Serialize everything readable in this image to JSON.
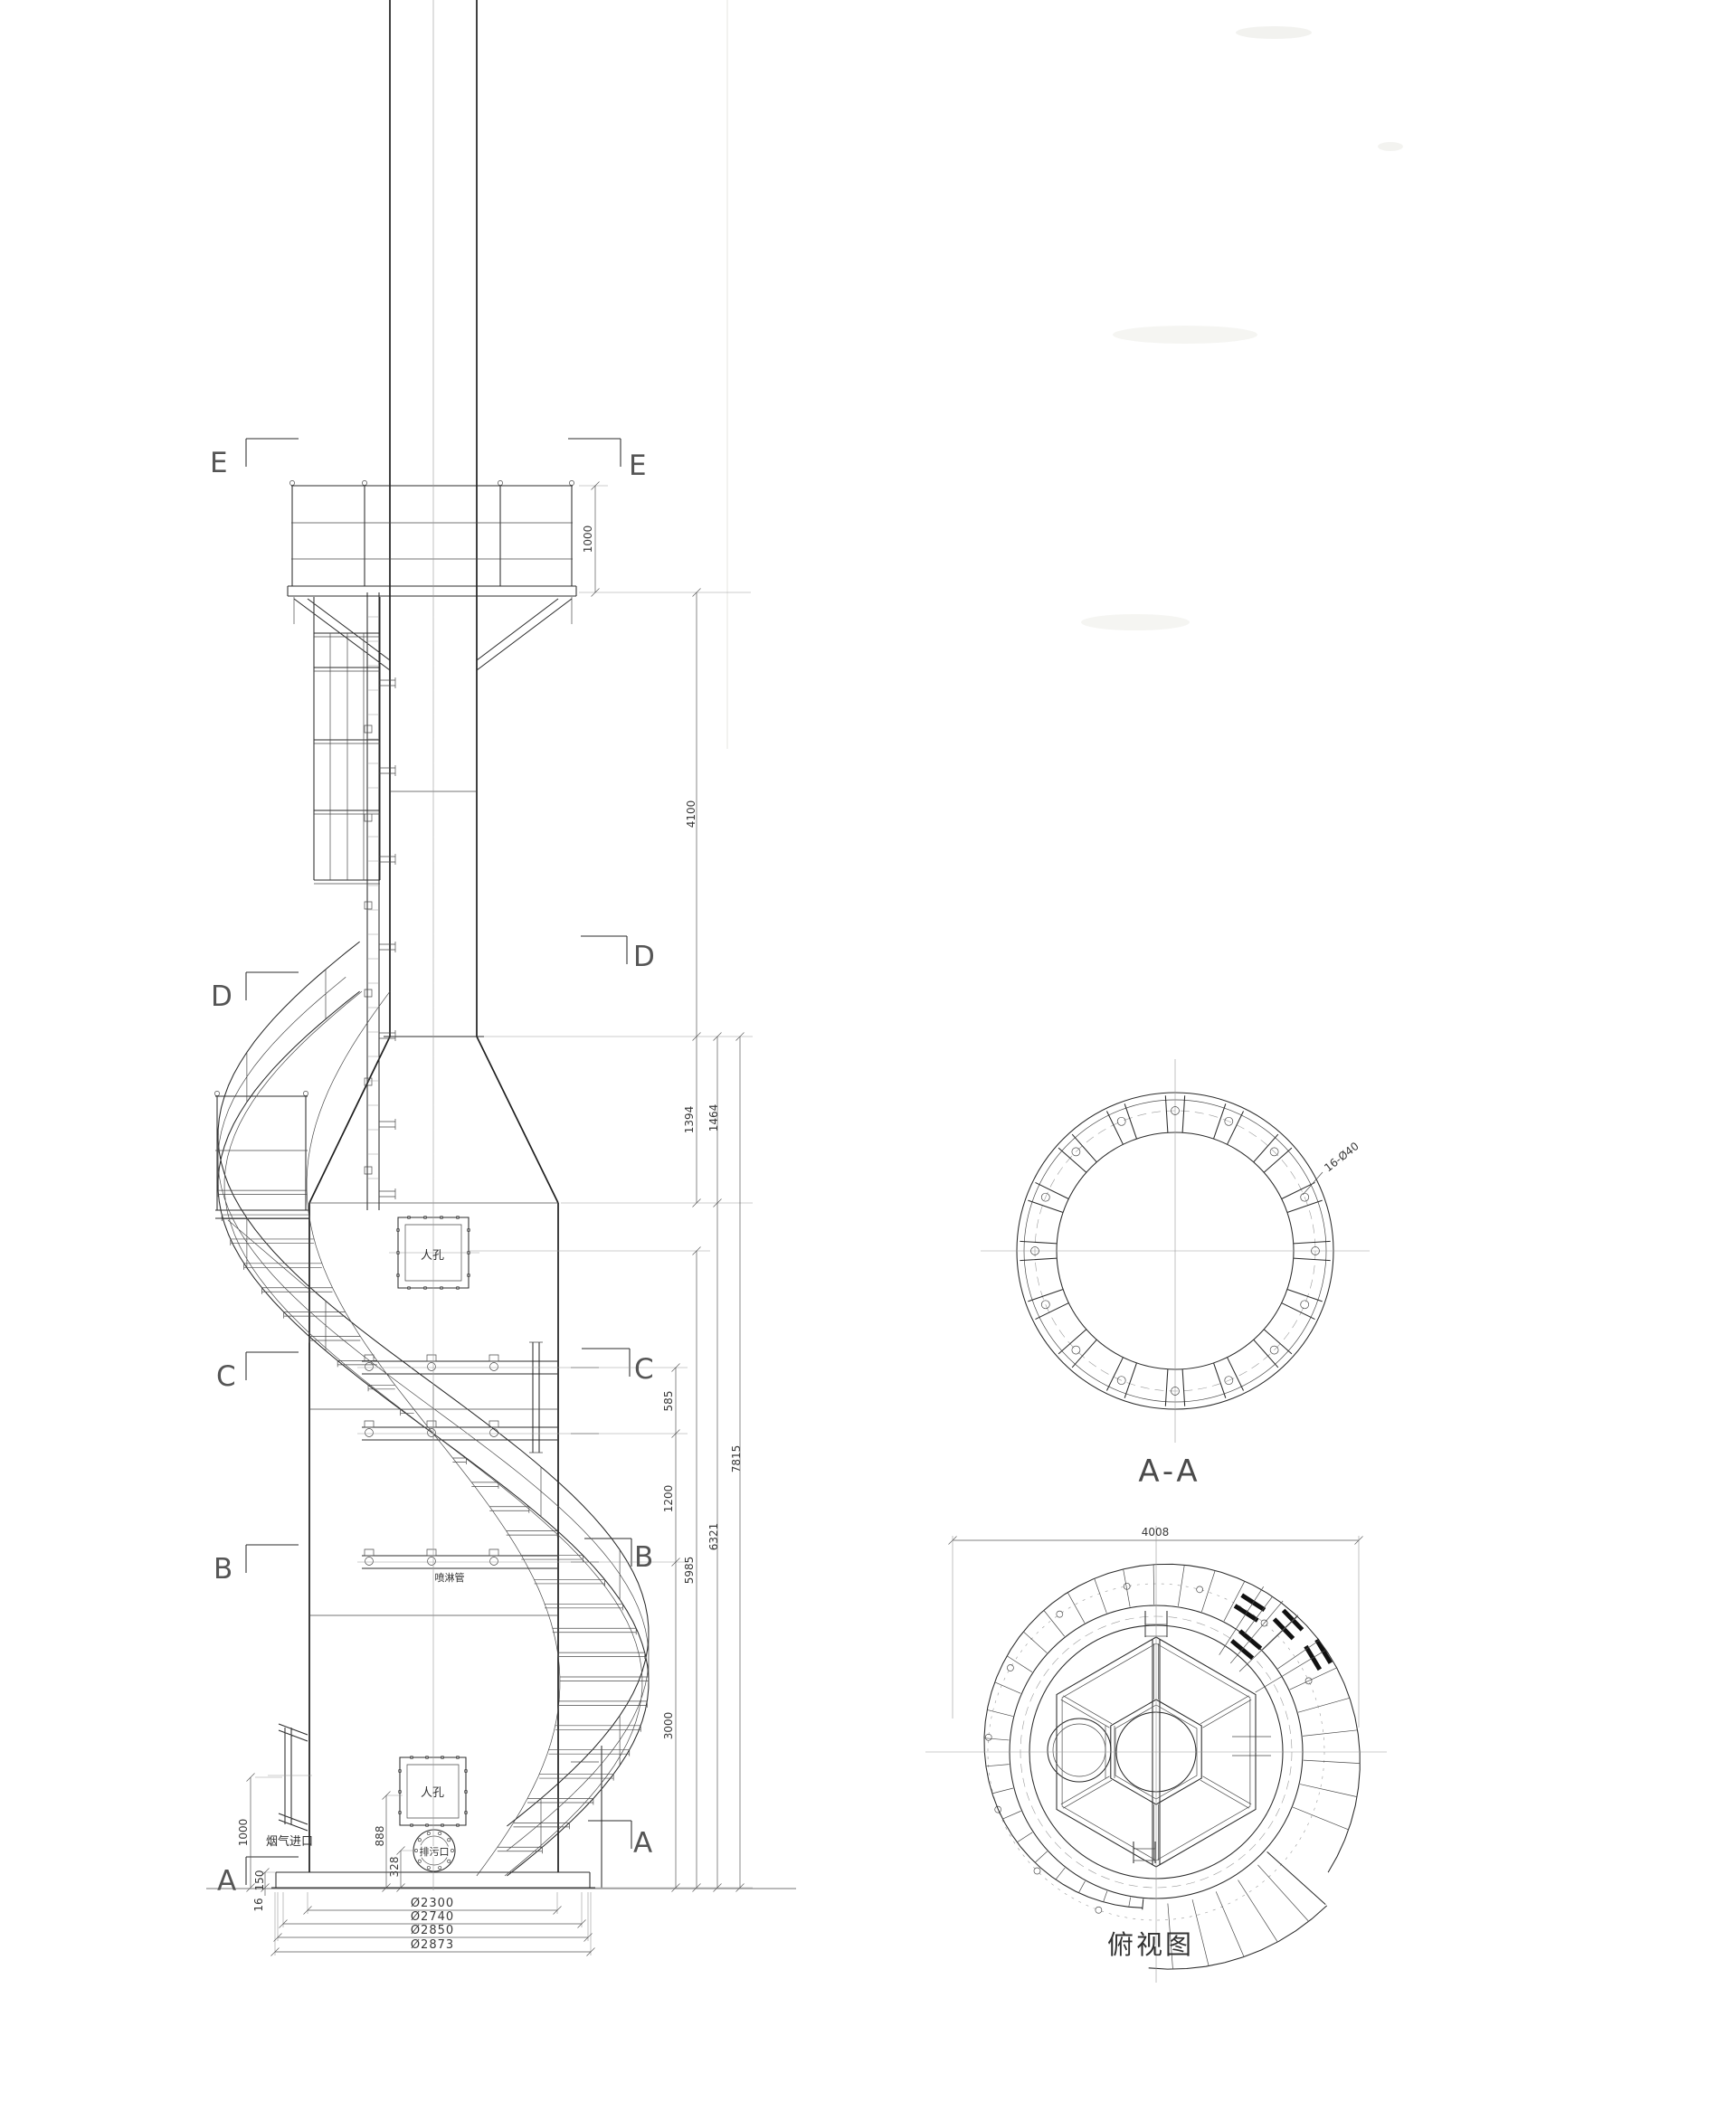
{
  "drawing_type": "chemical scrubber tower / chimney general arrangement drawing",
  "front_view": {
    "section_markers": {
      "e": "E",
      "d": "D",
      "c": "C",
      "b": "B",
      "a": "A"
    },
    "labels": {
      "manhole_upper": "人孔",
      "manhole_lower": "人孔",
      "spray_pipe": "喷淋管",
      "flue_inlet": "烟气进口",
      "drain": "排污口"
    },
    "dims": {
      "platform_rail": "1000",
      "upper_stack": "4100",
      "cone_a": "1394",
      "cone_b": "1464",
      "c_span": "585",
      "mid_span": "1200",
      "lower_span": "3000",
      "manhole_elev": "5985",
      "shell_elev": "6321",
      "total_elev": "7815",
      "inlet_elev": "1000",
      "manhole_low_elev": "888",
      "drain_elev": "328",
      "skirt_h": "150",
      "plate_t": "16",
      "dia_1": "Ø2300",
      "dia_2": "Ø2740",
      "dia_3": "Ø2850",
      "dia_4": "Ø2873"
    }
  },
  "section_aa": {
    "title": "A-A",
    "bolt_note": "16-Ø40"
  },
  "top_view": {
    "title": "俯视图",
    "width_dim": "4008"
  },
  "colors": {
    "line": "#1f1f1f",
    "paper": "#ffffff"
  }
}
